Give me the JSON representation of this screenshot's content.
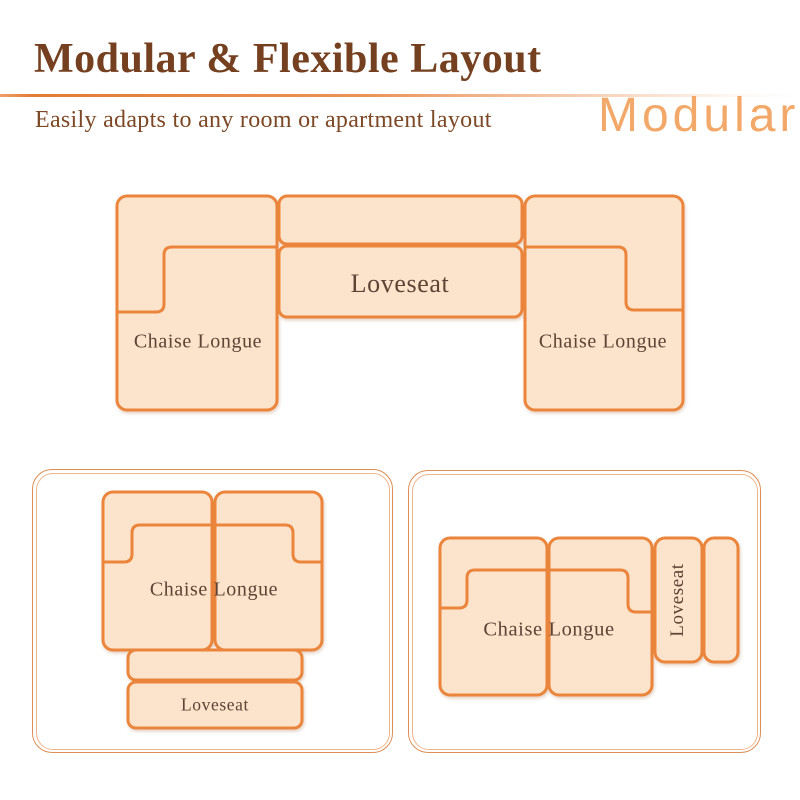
{
  "page": {
    "title": "Modular & Flexible Layout",
    "subtitle": "Easily adapts to any room or apartment layout",
    "watermark": "Modular"
  },
  "colors": {
    "accent": "#eb853c",
    "fill": "#fce3cc",
    "title": "#74401f",
    "subtitle": "#7d4825",
    "label": "#5d4435",
    "watermark": "#f09a4e",
    "panel_border": "#dc8e54",
    "panel_border_inner": "#efb58a"
  },
  "diagrams": {
    "top": {
      "left_chaise_label": "Chaise Longue",
      "loveseat_label": "Loveseat",
      "right_chaise_label": "Chaise Longue"
    },
    "bottom_left": {
      "chaise_label": "Chaise Longue",
      "loveseat_label": "Loveseat"
    },
    "bottom_right": {
      "chaise_label": "Chaise Longue",
      "loveseat_label": "Loveseat"
    }
  }
}
